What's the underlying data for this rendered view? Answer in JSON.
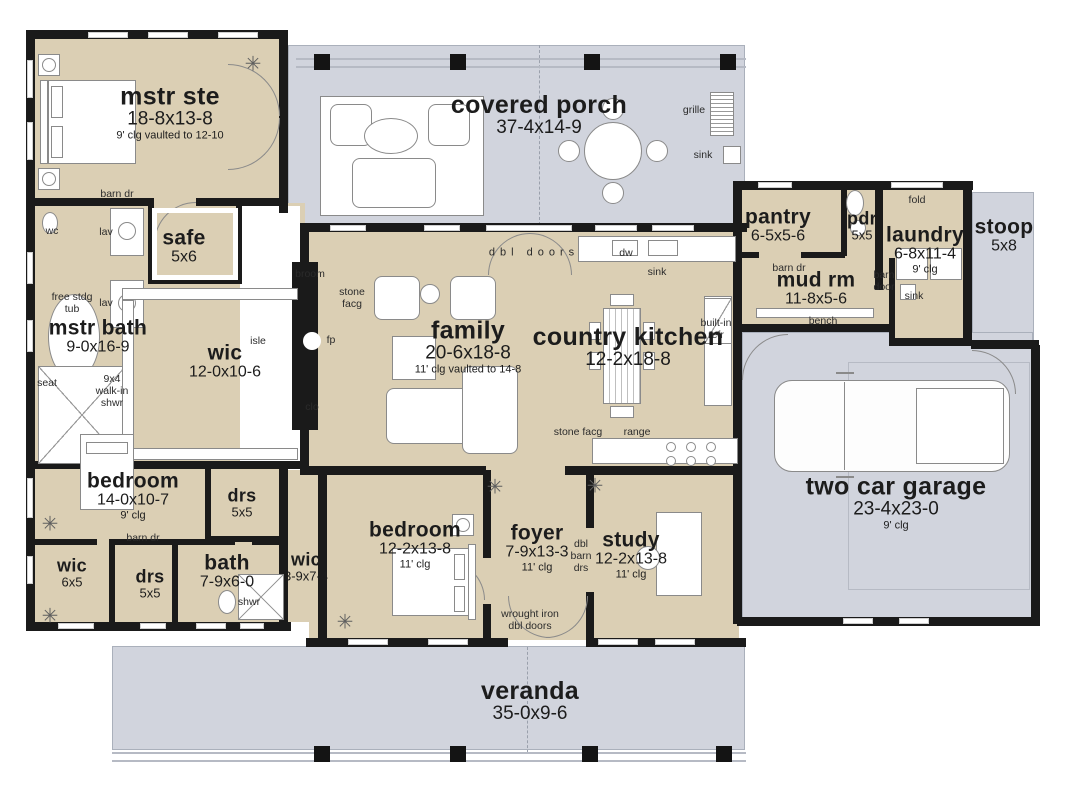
{
  "title": "house floor plan",
  "colors": {
    "room_fill": "#dbcfb4",
    "porch_fill": "#d1d4dd",
    "wall": "#1a1a1a",
    "line": "#8a8a8a",
    "text": "#1c1c1c"
  },
  "icons": {
    "plant": "✳"
  },
  "rooms": [
    {
      "id": "mstr-ste",
      "name": "mstr ste",
      "dims": "18-8x13-8",
      "note": "9' clg vaulted to 12-10",
      "x": 170,
      "y": 113,
      "size": "lg"
    },
    {
      "id": "covered-porch",
      "name": "covered porch",
      "dims": "37-4x14-9",
      "note": "",
      "x": 539,
      "y": 115,
      "size": "lg"
    },
    {
      "id": "pantry",
      "name": "pantry",
      "dims": "6-5x5-6",
      "note": "",
      "x": 778,
      "y": 226,
      "size": "md"
    },
    {
      "id": "pdr",
      "name": "pdr",
      "dims": "5x5",
      "note": "",
      "x": 862,
      "y": 226,
      "size": "sm"
    },
    {
      "id": "laundry",
      "name": "laundry",
      "dims": "6-8x11-4",
      "note": "9' clg",
      "x": 925,
      "y": 250,
      "size": "md"
    },
    {
      "id": "stoop",
      "name": "stoop",
      "dims": "5x8",
      "note": "",
      "x": 1004,
      "y": 236,
      "size": "md"
    },
    {
      "id": "mud-rm",
      "name": "mud rm",
      "dims": "11-8x5-6",
      "note": "",
      "x": 816,
      "y": 289,
      "size": "md"
    },
    {
      "id": "safe",
      "name": "safe",
      "dims": "5x6",
      "note": "",
      "x": 184,
      "y": 247,
      "size": "md"
    },
    {
      "id": "mstr-bath",
      "name": "mstr bath",
      "dims": "9-0x16-9",
      "note": "",
      "x": 98,
      "y": 337,
      "size": "md"
    },
    {
      "id": "wic-master",
      "name": "wic",
      "dims": "12-0x10-6",
      "note": "",
      "x": 225,
      "y": 362,
      "size": "md"
    },
    {
      "id": "family",
      "name": "family",
      "dims": "20-6x18-8",
      "note": "11' clg vaulted to 14-8",
      "x": 468,
      "y": 347,
      "size": "lg"
    },
    {
      "id": "country-kitchen",
      "name": "country kitchen",
      "dims": "12-2x18-8",
      "note": "",
      "x": 628,
      "y": 347,
      "size": "lg"
    },
    {
      "id": "two-car-garage",
      "name": "two car garage",
      "dims": "23-4x23-0",
      "note": "9' clg",
      "x": 896,
      "y": 503,
      "size": "lg"
    },
    {
      "id": "bedroom-1",
      "name": "bedroom",
      "dims": "14-0x10-7",
      "note": "9' clg",
      "x": 133,
      "y": 496,
      "size": "md"
    },
    {
      "id": "wic-small",
      "name": "wic",
      "dims": "6x5",
      "note": "",
      "x": 72,
      "y": 573,
      "size": "sm"
    },
    {
      "id": "drs-left",
      "name": "drs",
      "dims": "5x5",
      "note": "",
      "x": 150,
      "y": 584,
      "size": "sm"
    },
    {
      "id": "bath",
      "name": "bath",
      "dims": "7-9x6-0",
      "note": "",
      "x": 227,
      "y": 572,
      "size": "md"
    },
    {
      "id": "drs-right",
      "name": "drs",
      "dims": "5x5",
      "note": "",
      "x": 242,
      "y": 503,
      "size": "sm"
    },
    {
      "id": "wic-hall",
      "name": "wic",
      "dims": "3-9x7-4",
      "note": "",
      "x": 306,
      "y": 567,
      "size": "sm"
    },
    {
      "id": "bedroom-2",
      "name": "bedroom",
      "dims": "12-2x13-8",
      "note": "11' clg",
      "x": 415,
      "y": 545,
      "size": "md"
    },
    {
      "id": "foyer",
      "name": "foyer",
      "dims": "7-9x13-3",
      "note": "11' clg",
      "x": 537,
      "y": 548,
      "size": "md"
    },
    {
      "id": "study",
      "name": "study",
      "dims": "12-2x13-8",
      "note": "11' clg",
      "x": 631,
      "y": 555,
      "size": "md"
    },
    {
      "id": "veranda",
      "name": "veranda",
      "dims": "35-0x9-6",
      "note": "",
      "x": 530,
      "y": 701,
      "size": "lg"
    }
  ],
  "labels": [
    {
      "id": "barn-dr-master",
      "lines": [
        "barn dr"
      ],
      "x": 117,
      "y": 194
    },
    {
      "id": "wc",
      "lines": [
        "wc"
      ],
      "x": 52,
      "y": 231
    },
    {
      "id": "lav-upper",
      "lines": [
        "lav"
      ],
      "x": 106,
      "y": 232
    },
    {
      "id": "free-stdg-tub",
      "lines": [
        "free stdg",
        "tub"
      ],
      "x": 72,
      "y": 303
    },
    {
      "id": "lav-lower",
      "lines": [
        "lav"
      ],
      "x": 106,
      "y": 303
    },
    {
      "id": "seat",
      "lines": [
        "seat"
      ],
      "x": 47,
      "y": 383
    },
    {
      "id": "walk-in-shwr",
      "lines": [
        "9x4",
        "walk-in",
        "shwr"
      ],
      "x": 112,
      "y": 391
    },
    {
      "id": "isle",
      "lines": [
        "isle"
      ],
      "x": 258,
      "y": 341
    },
    {
      "id": "broom",
      "lines": [
        "broom"
      ],
      "x": 310,
      "y": 274
    },
    {
      "id": "stone-facg-left",
      "lines": [
        "stone",
        "facg"
      ],
      "x": 352,
      "y": 298
    },
    {
      "id": "fp",
      "lines": [
        "fp"
      ],
      "x": 331,
      "y": 340
    },
    {
      "id": "clo",
      "lines": [
        "clo"
      ],
      "x": 312,
      "y": 407
    },
    {
      "id": "dbl-doors",
      "lines": [
        "dbl doors"
      ],
      "x": 534,
      "y": 253,
      "style": "spaced"
    },
    {
      "id": "dw",
      "lines": [
        "dw"
      ],
      "x": 626,
      "y": 253
    },
    {
      "id": "sink-kitchen",
      "lines": [
        "sink"
      ],
      "x": 657,
      "y": 272
    },
    {
      "id": "grille",
      "lines": [
        "grille"
      ],
      "x": 694,
      "y": 110
    },
    {
      "id": "sink-porch",
      "lines": [
        "sink"
      ],
      "x": 703,
      "y": 155
    },
    {
      "id": "built-in-refr",
      "lines": [
        "built-in",
        "refr"
      ],
      "x": 716,
      "y": 329
    },
    {
      "id": "stone-facg-btm",
      "lines": [
        "stone facg"
      ],
      "x": 578,
      "y": 432
    },
    {
      "id": "range",
      "lines": [
        "range"
      ],
      "x": 637,
      "y": 432
    },
    {
      "id": "fold",
      "lines": [
        "fold"
      ],
      "x": 917,
      "y": 200
    },
    {
      "id": "barn-dr-mudrm",
      "lines": [
        "barn dr"
      ],
      "x": 789,
      "y": 268
    },
    {
      "id": "barn-door-laund",
      "lines": [
        "barn",
        "door"
      ],
      "x": 884,
      "y": 281
    },
    {
      "id": "sink-laundry",
      "lines": [
        "sink"
      ],
      "x": 914,
      "y": 296
    },
    {
      "id": "bench",
      "lines": [
        "bench"
      ],
      "x": 823,
      "y": 321
    },
    {
      "id": "barn-dr-bedroom",
      "lines": [
        "barn dr"
      ],
      "x": 143,
      "y": 538
    },
    {
      "id": "shwr-bath",
      "lines": [
        "shwr"
      ],
      "x": 249,
      "y": 602
    },
    {
      "id": "dbl-barn-drs",
      "lines": [
        "dbl",
        "barn",
        "drs"
      ],
      "x": 581,
      "y": 556
    },
    {
      "id": "wrought-iron",
      "lines": [
        "wrought iron",
        "dbl doors"
      ],
      "x": 530,
      "y": 620
    }
  ],
  "plants": [
    {
      "x": 253,
      "y": 64
    },
    {
      "x": 50,
      "y": 524
    },
    {
      "x": 50,
      "y": 616
    },
    {
      "x": 345,
      "y": 622
    },
    {
      "x": 495,
      "y": 487
    },
    {
      "x": 595,
      "y": 486
    }
  ]
}
